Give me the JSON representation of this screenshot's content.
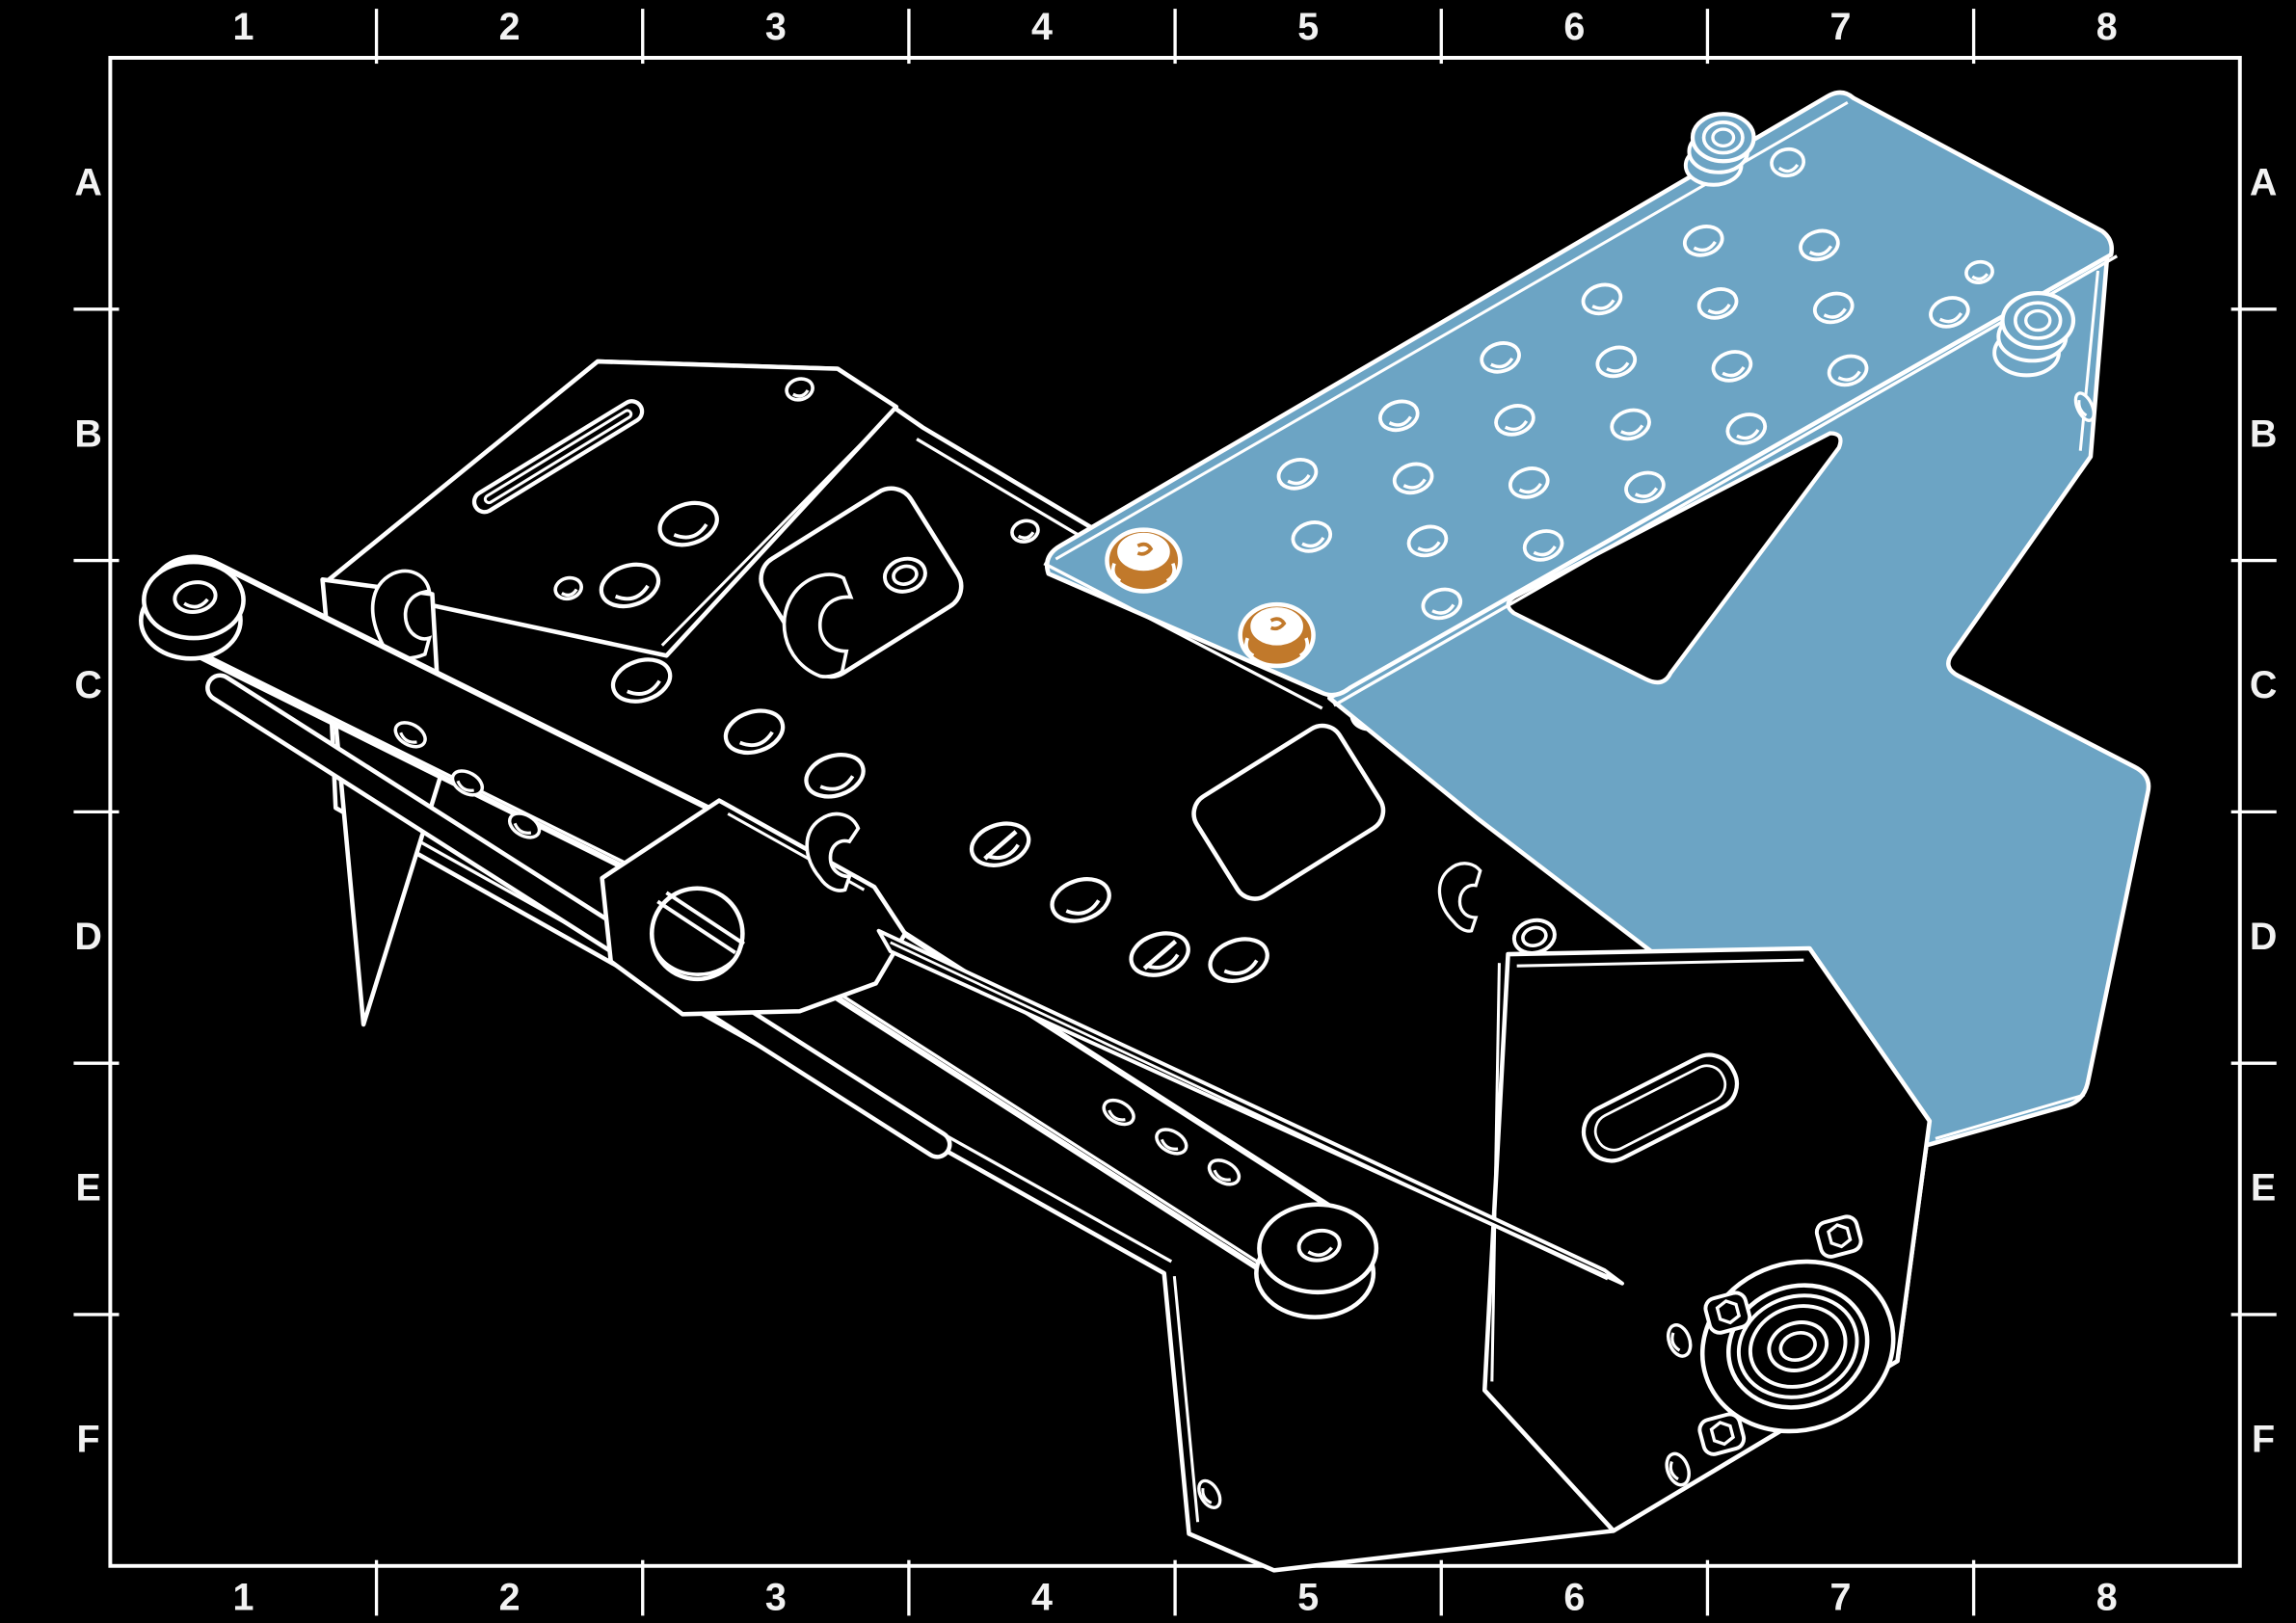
{
  "frame": {
    "column_labels": [
      "1",
      "2",
      "3",
      "4",
      "5",
      "6",
      "7",
      "8"
    ],
    "row_labels": [
      "A",
      "B",
      "C",
      "D",
      "E",
      "F"
    ]
  },
  "colors": {
    "background": "#000000",
    "line": "#ffffff",
    "highlight_part": "#6ca4c4",
    "fastener": "#c1792b",
    "grid_label": "#f2f2f2"
  }
}
